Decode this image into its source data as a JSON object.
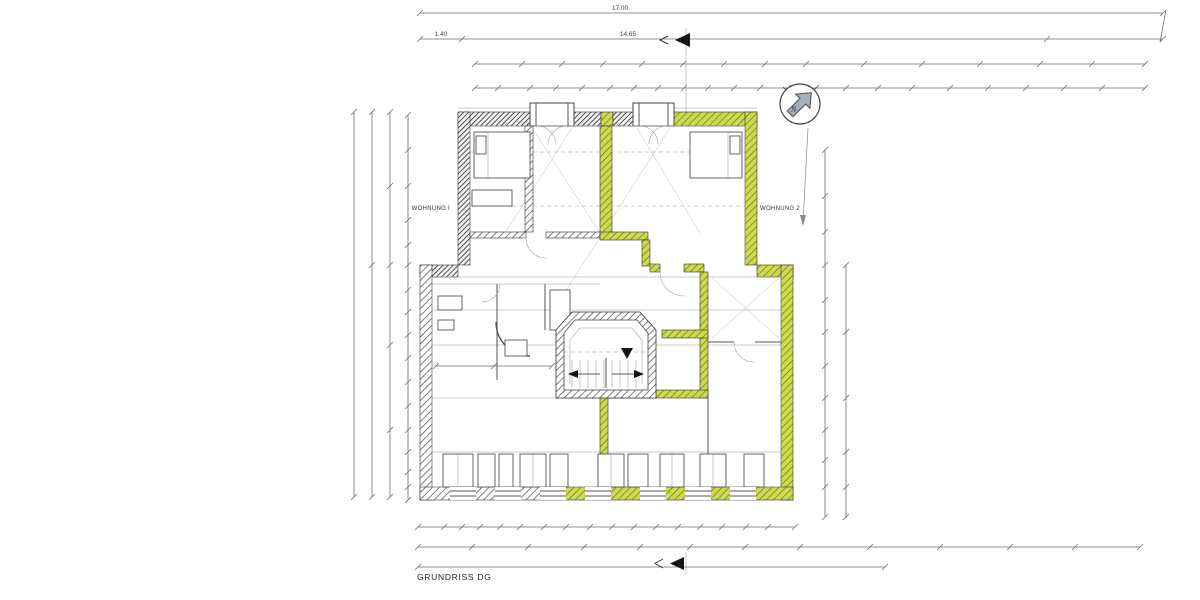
{
  "document": {
    "title": "GRUNDRISS DG"
  },
  "labels": {
    "apartment_left": "WOHNUNG I",
    "apartment_right": "WOHNUNG 2"
  },
  "compass": {
    "letter": "N"
  },
  "dimensions": {
    "top_total": "17.00",
    "top_segment_left": "1.40",
    "top_segment_main": "14.65"
  },
  "colors": {
    "highlight": "#cdd94e",
    "wall_hatch": "#3f3f3f",
    "dimension_line": "#6f6f6f",
    "paper": "#ffffff",
    "compass_arrow": "#a7b0b8"
  }
}
